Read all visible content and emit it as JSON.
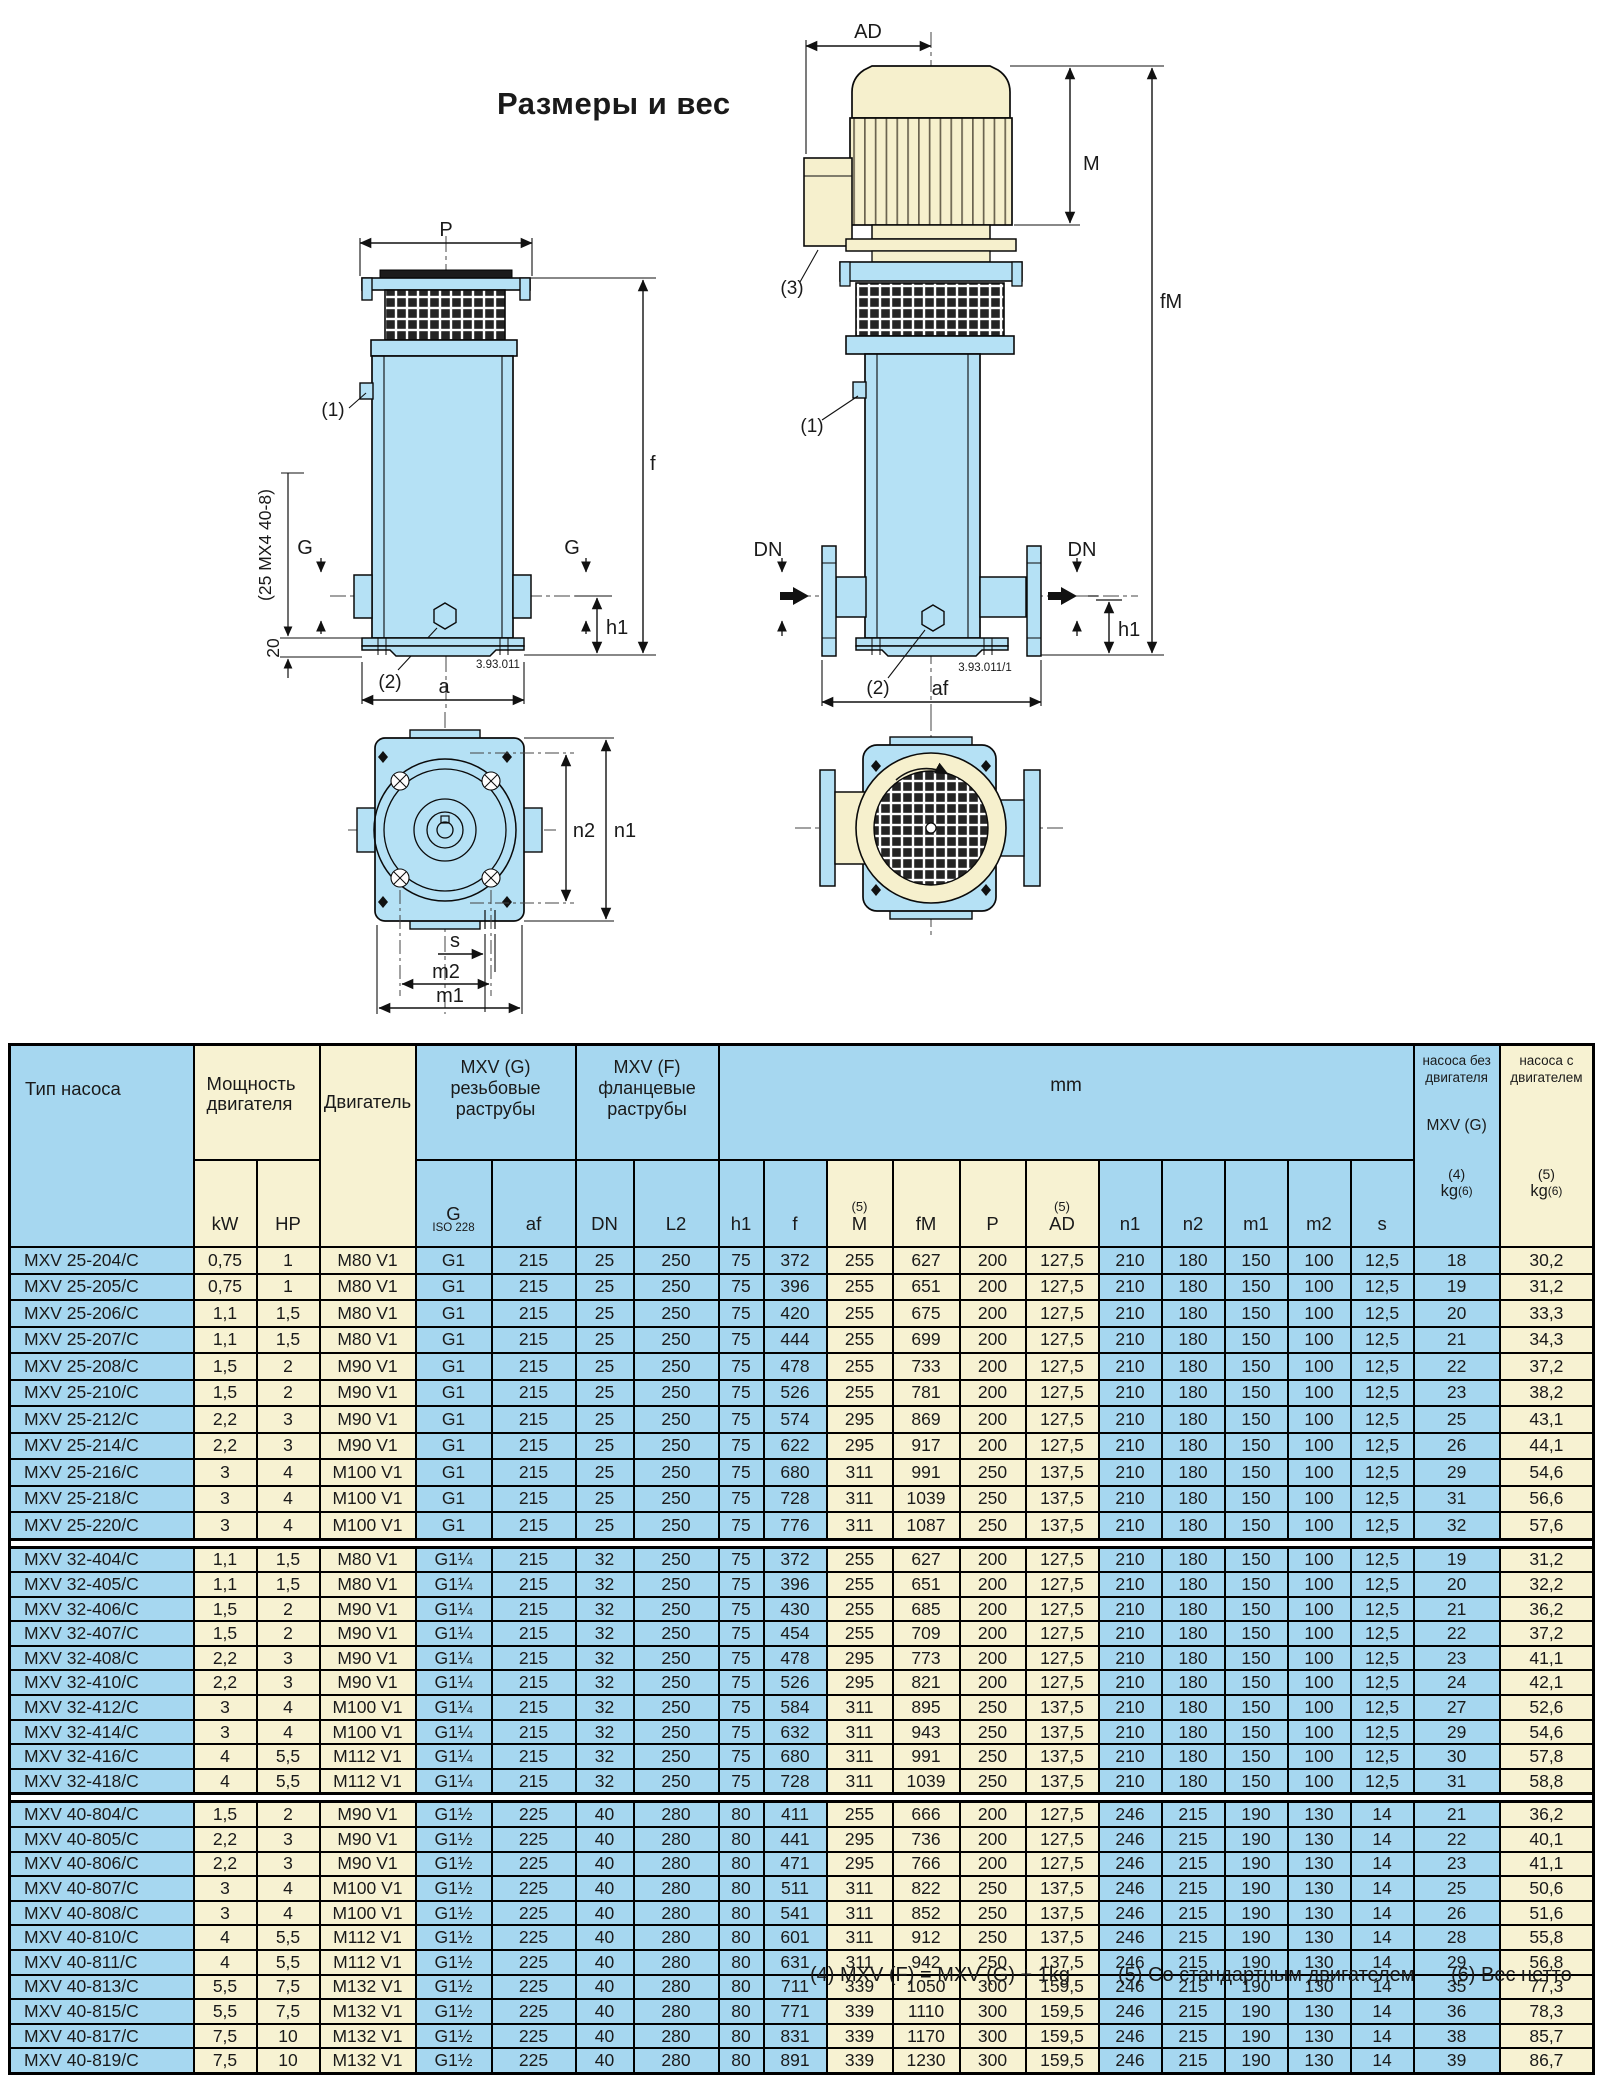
{
  "title": "Размеры и вес",
  "drawings": {
    "threaded": {
      "p": "P",
      "f": "f",
      "g_left": "G",
      "g_right": "G",
      "h1": "h1",
      "a": "a",
      "callout1": "(1)",
      "callout2": "(2)",
      "height_note": "(25 MX4 40-8)",
      "base_note": "20",
      "code": "3.93.011"
    },
    "flanged": {
      "ad": "AD",
      "m": "M",
      "fm": "fM",
      "dn_left": "DN",
      "dn_right": "DN",
      "h1": "h1",
      "af": "af",
      "callout1": "(1)",
      "callout2": "(2)",
      "callout3": "(3)",
      "code": "3.93.011/1"
    },
    "footprint": {
      "n1": "n1",
      "n2": "n2",
      "s": "s",
      "m1": "m1",
      "m2": "m2"
    }
  },
  "table": {
    "header": {
      "pump_type": "Тип насоса",
      "power": [
        "Мощность",
        "двигателя"
      ],
      "motor": "Двигатель",
      "mxv_g": [
        "MXV (G)",
        "резьбовые",
        "раструбы"
      ],
      "mxv_f": [
        "MXV (F)",
        "фланцевые",
        "раструбы"
      ],
      "mm": "mm",
      "weight_bare": {
        "lines": [
          "насоса без",
          "двигателя"
        ],
        "mid": "MXV (G)",
        "note": "(4)",
        "unit": "kg",
        "unit_note": "(6)"
      },
      "weight_motor": {
        "lines": [
          "насоса с",
          "двигателем"
        ],
        "note": "(5)",
        "unit": "kg",
        "unit_note": "(6)"
      },
      "sub": [
        {
          "label": "kW"
        },
        {
          "label": "HP"
        },
        {
          "label": "G",
          "small": "ISO 228"
        },
        {
          "label": "af"
        },
        {
          "label": "DN"
        },
        {
          "label": "L2"
        },
        {
          "label": "h1"
        },
        {
          "label": "f"
        },
        {
          "label": "M",
          "note": "(5)"
        },
        {
          "label": "fM"
        },
        {
          "label": "P"
        },
        {
          "label": "AD",
          "note": "(5)"
        },
        {
          "label": "n1"
        },
        {
          "label": "n2"
        },
        {
          "label": "m1"
        },
        {
          "label": "m2"
        },
        {
          "label": "s"
        }
      ]
    },
    "blocks": [
      [
        [
          "MXV 25-204/C",
          "0,75",
          "1",
          "M80 V1",
          "G1",
          "215",
          "25",
          "250",
          "75",
          "372",
          "255",
          "627",
          "200",
          "127,5",
          "210",
          "180",
          "150",
          "100",
          "12,5",
          "18",
          "30,2"
        ],
        [
          "MXV 25-205/C",
          "0,75",
          "1",
          "M80 V1",
          "G1",
          "215",
          "25",
          "250",
          "75",
          "396",
          "255",
          "651",
          "200",
          "127,5",
          "210",
          "180",
          "150",
          "100",
          "12,5",
          "19",
          "31,2"
        ],
        [
          "MXV 25-206/C",
          "1,1",
          "1,5",
          "M80 V1",
          "G1",
          "215",
          "25",
          "250",
          "75",
          "420",
          "255",
          "675",
          "200",
          "127,5",
          "210",
          "180",
          "150",
          "100",
          "12,5",
          "20",
          "33,3"
        ],
        [
          "MXV 25-207/C",
          "1,1",
          "1,5",
          "M80 V1",
          "G1",
          "215",
          "25",
          "250",
          "75",
          "444",
          "255",
          "699",
          "200",
          "127,5",
          "210",
          "180",
          "150",
          "100",
          "12,5",
          "21",
          "34,3"
        ],
        [
          "MXV 25-208/C",
          "1,5",
          "2",
          "M90 V1",
          "G1",
          "215",
          "25",
          "250",
          "75",
          "478",
          "255",
          "733",
          "200",
          "127,5",
          "210",
          "180",
          "150",
          "100",
          "12,5",
          "22",
          "37,2"
        ],
        [
          "MXV 25-210/C",
          "1,5",
          "2",
          "M90 V1",
          "G1",
          "215",
          "25",
          "250",
          "75",
          "526",
          "255",
          "781",
          "200",
          "127,5",
          "210",
          "180",
          "150",
          "100",
          "12,5",
          "23",
          "38,2"
        ],
        [
          "MXV 25-212/C",
          "2,2",
          "3",
          "M90 V1",
          "G1",
          "215",
          "25",
          "250",
          "75",
          "574",
          "295",
          "869",
          "200",
          "127,5",
          "210",
          "180",
          "150",
          "100",
          "12,5",
          "25",
          "43,1"
        ],
        [
          "MXV 25-214/C",
          "2,2",
          "3",
          "M90 V1",
          "G1",
          "215",
          "25",
          "250",
          "75",
          "622",
          "295",
          "917",
          "200",
          "127,5",
          "210",
          "180",
          "150",
          "100",
          "12,5",
          "26",
          "44,1"
        ],
        [
          "MXV 25-216/C",
          "3",
          "4",
          "M100 V1",
          "G1",
          "215",
          "25",
          "250",
          "75",
          "680",
          "311",
          "991",
          "250",
          "137,5",
          "210",
          "180",
          "150",
          "100",
          "12,5",
          "29",
          "54,6"
        ],
        [
          "MXV 25-218/C",
          "3",
          "4",
          "M100 V1",
          "G1",
          "215",
          "25",
          "250",
          "75",
          "728",
          "311",
          "1039",
          "250",
          "137,5",
          "210",
          "180",
          "150",
          "100",
          "12,5",
          "31",
          "56,6"
        ],
        [
          "MXV 25-220/C",
          "3",
          "4",
          "M100 V1",
          "G1",
          "215",
          "25",
          "250",
          "75",
          "776",
          "311",
          "1087",
          "250",
          "137,5",
          "210",
          "180",
          "150",
          "100",
          "12,5",
          "32",
          "57,6"
        ]
      ],
      [
        [
          "MXV 32-404/C",
          "1,1",
          "1,5",
          "M80 V1",
          "G1¼",
          "215",
          "32",
          "250",
          "75",
          "372",
          "255",
          "627",
          "200",
          "127,5",
          "210",
          "180",
          "150",
          "100",
          "12,5",
          "19",
          "31,2"
        ],
        [
          "MXV 32-405/C",
          "1,1",
          "1,5",
          "M80 V1",
          "G1¼",
          "215",
          "32",
          "250",
          "75",
          "396",
          "255",
          "651",
          "200",
          "127,5",
          "210",
          "180",
          "150",
          "100",
          "12,5",
          "20",
          "32,2"
        ],
        [
          "MXV 32-406/C",
          "1,5",
          "2",
          "M90 V1",
          "G1¼",
          "215",
          "32",
          "250",
          "75",
          "430",
          "255",
          "685",
          "200",
          "127,5",
          "210",
          "180",
          "150",
          "100",
          "12,5",
          "21",
          "36,2"
        ],
        [
          "MXV 32-407/C",
          "1,5",
          "2",
          "M90 V1",
          "G1¼",
          "215",
          "32",
          "250",
          "75",
          "454",
          "255",
          "709",
          "200",
          "127,5",
          "210",
          "180",
          "150",
          "100",
          "12,5",
          "22",
          "37,2"
        ],
        [
          "MXV 32-408/C",
          "2,2",
          "3",
          "M90 V1",
          "G1¼",
          "215",
          "32",
          "250",
          "75",
          "478",
          "295",
          "773",
          "200",
          "127,5",
          "210",
          "180",
          "150",
          "100",
          "12,5",
          "23",
          "41,1"
        ],
        [
          "MXV 32-410/C",
          "2,2",
          "3",
          "M90 V1",
          "G1¼",
          "215",
          "32",
          "250",
          "75",
          "526",
          "295",
          "821",
          "200",
          "127,5",
          "210",
          "180",
          "150",
          "100",
          "12,5",
          "24",
          "42,1"
        ],
        [
          "MXV 32-412/C",
          "3",
          "4",
          "M100 V1",
          "G1¼",
          "215",
          "32",
          "250",
          "75",
          "584",
          "311",
          "895",
          "250",
          "137,5",
          "210",
          "180",
          "150",
          "100",
          "12,5",
          "27",
          "52,6"
        ],
        [
          "MXV 32-414/C",
          "3",
          "4",
          "M100 V1",
          "G1¼",
          "215",
          "32",
          "250",
          "75",
          "632",
          "311",
          "943",
          "250",
          "137,5",
          "210",
          "180",
          "150",
          "100",
          "12,5",
          "29",
          "54,6"
        ],
        [
          "MXV 32-416/C",
          "4",
          "5,5",
          "M112 V1",
          "G1¼",
          "215",
          "32",
          "250",
          "75",
          "680",
          "311",
          "991",
          "250",
          "137,5",
          "210",
          "180",
          "150",
          "100",
          "12,5",
          "30",
          "57,8"
        ],
        [
          "MXV 32-418/C",
          "4",
          "5,5",
          "M112 V1",
          "G1¼",
          "215",
          "32",
          "250",
          "75",
          "728",
          "311",
          "1039",
          "250",
          "137,5",
          "210",
          "180",
          "150",
          "100",
          "12,5",
          "31",
          "58,8"
        ]
      ],
      [
        [
          "MXV 40-804/C",
          "1,5",
          "2",
          "M90 V1",
          "G1½",
          "225",
          "40",
          "280",
          "80",
          "411",
          "255",
          "666",
          "200",
          "127,5",
          "246",
          "215",
          "190",
          "130",
          "14",
          "21",
          "36,2"
        ],
        [
          "MXV 40-805/C",
          "2,2",
          "3",
          "M90 V1",
          "G1½",
          "225",
          "40",
          "280",
          "80",
          "441",
          "295",
          "736",
          "200",
          "127,5",
          "246",
          "215",
          "190",
          "130",
          "14",
          "22",
          "40,1"
        ],
        [
          "MXV 40-806/C",
          "2,2",
          "3",
          "M90 V1",
          "G1½",
          "225",
          "40",
          "280",
          "80",
          "471",
          "295",
          "766",
          "200",
          "127,5",
          "246",
          "215",
          "190",
          "130",
          "14",
          "23",
          "41,1"
        ],
        [
          "MXV 40-807/C",
          "3",
          "4",
          "M100 V1",
          "G1½",
          "225",
          "40",
          "280",
          "80",
          "511",
          "311",
          "822",
          "250",
          "137,5",
          "246",
          "215",
          "190",
          "130",
          "14",
          "25",
          "50,6"
        ],
        [
          "MXV 40-808/C",
          "3",
          "4",
          "M100 V1",
          "G1½",
          "225",
          "40",
          "280",
          "80",
          "541",
          "311",
          "852",
          "250",
          "137,5",
          "246",
          "215",
          "190",
          "130",
          "14",
          "26",
          "51,6"
        ],
        [
          "MXV 40-810/C",
          "4",
          "5,5",
          "M112 V1",
          "G1½",
          "225",
          "40",
          "280",
          "80",
          "601",
          "311",
          "912",
          "250",
          "137,5",
          "246",
          "215",
          "190",
          "130",
          "14",
          "28",
          "55,8"
        ],
        [
          "MXV 40-811/C",
          "4",
          "5,5",
          "M112 V1",
          "G1½",
          "225",
          "40",
          "280",
          "80",
          "631",
          "311",
          "942",
          "250",
          "137,5",
          "246",
          "215",
          "190",
          "130",
          "14",
          "29",
          "56,8"
        ],
        [
          "MXV 40-813/C",
          "5,5",
          "7,5",
          "M132 V1",
          "G1½",
          "225",
          "40",
          "280",
          "80",
          "711",
          "339",
          "1050",
          "300",
          "159,5",
          "246",
          "215",
          "190",
          "130",
          "14",
          "35",
          "77,3"
        ],
        [
          "MXV 40-815/C",
          "5,5",
          "7,5",
          "M132 V1",
          "G1½",
          "225",
          "40",
          "280",
          "80",
          "771",
          "339",
          "1110",
          "300",
          "159,5",
          "246",
          "215",
          "190",
          "130",
          "14",
          "36",
          "78,3"
        ],
        [
          "MXV 40-817/C",
          "7,5",
          "10",
          "M132 V1",
          "G1½",
          "225",
          "40",
          "280",
          "80",
          "831",
          "339",
          "1170",
          "300",
          "159,5",
          "246",
          "215",
          "190",
          "130",
          "14",
          "38",
          "85,7"
        ],
        [
          "MXV 40-819/C",
          "7,5",
          "10",
          "M132 V1",
          "G1½",
          "225",
          "40",
          "280",
          "80",
          "891",
          "339",
          "1230",
          "300",
          "159,5",
          "246",
          "215",
          "190",
          "130",
          "14",
          "39",
          "86,7"
        ]
      ]
    ]
  },
  "footnotes": [
    "(4) MXV (F) = MXV (G) + 1kg",
    "(5) Со стандартным двигателем",
    "(6) Вес нетто"
  ],
  "colors": {
    "table_blue": "#a6d7f0",
    "table_cream": "#f7f2d2",
    "drawing_blue": "#b5e1f5",
    "drawing_cream": "#f6f0cd"
  }
}
